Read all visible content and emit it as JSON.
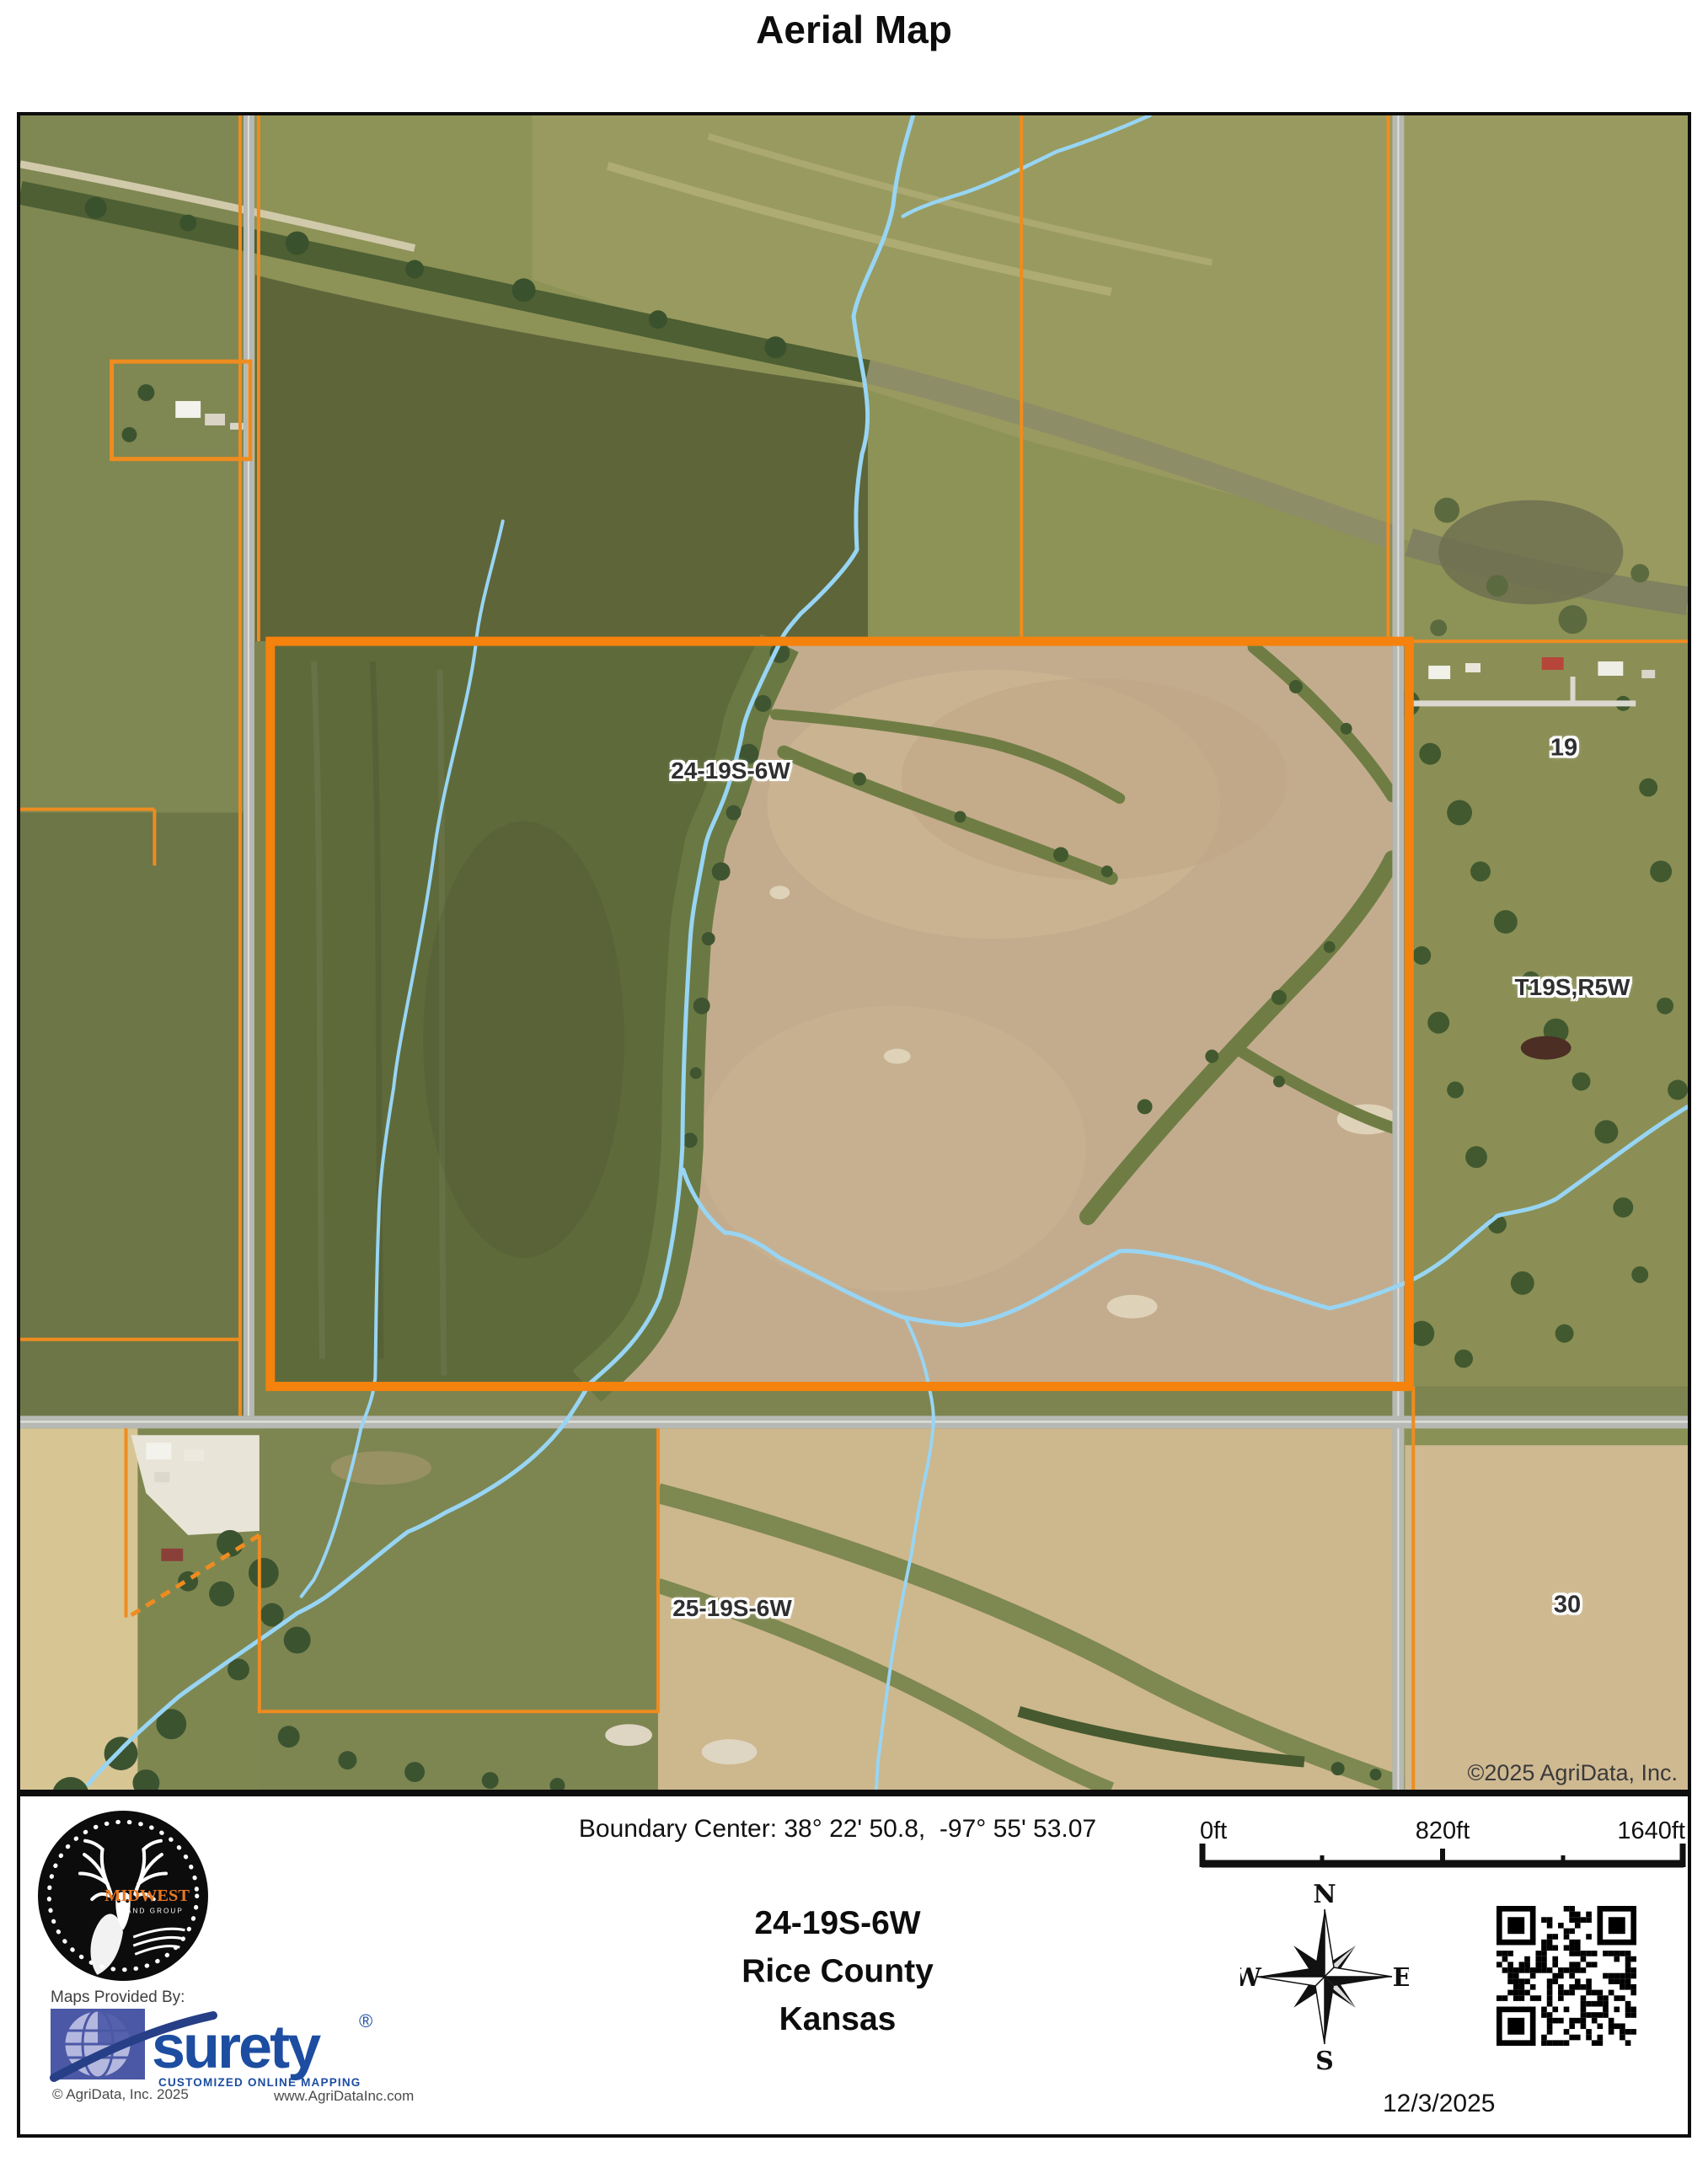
{
  "page": {
    "title": "Aerial Map",
    "background": "#ffffff"
  },
  "map": {
    "labels": {
      "section_24": "24-19S-6W",
      "section_25": "25-19S-6W",
      "section_19": "19",
      "township_range": "T19S,R5W",
      "section_30": "30",
      "imagery_credit": "©2025 AgriData, Inc."
    },
    "colors": {
      "parcel_boundary": "#f5820d",
      "section_line": "#ef8c1f",
      "stream": "#98d5f4",
      "road": "#b6b9b3"
    }
  },
  "footer": {
    "boundary_center": "Boundary Center: 38° 22' 50.8,  -97° 55' 53.07",
    "location": {
      "section": "24-19S-6W",
      "county": "Rice County",
      "state": "Kansas"
    },
    "scale_bar": {
      "start_label": "0ft",
      "mid_label": "820ft",
      "end_label": "1640ft"
    },
    "compass": {
      "north": "N",
      "east": "E",
      "south": "S",
      "west": "W"
    },
    "date": "12/3/2025",
    "branding": {
      "maps_provided_by": "Maps Provided By:",
      "brand_name": "surety",
      "registered_mark": "®",
      "tagline": "CUSTOMIZED ONLINE MAPPING",
      "agridata_copyright": "© AgriData, Inc. 2025",
      "website": "www.AgriDataInc.com",
      "midwest_logo_name": "MIDWEST",
      "midwest_logo_sub": "LAND GROUP"
    }
  }
}
